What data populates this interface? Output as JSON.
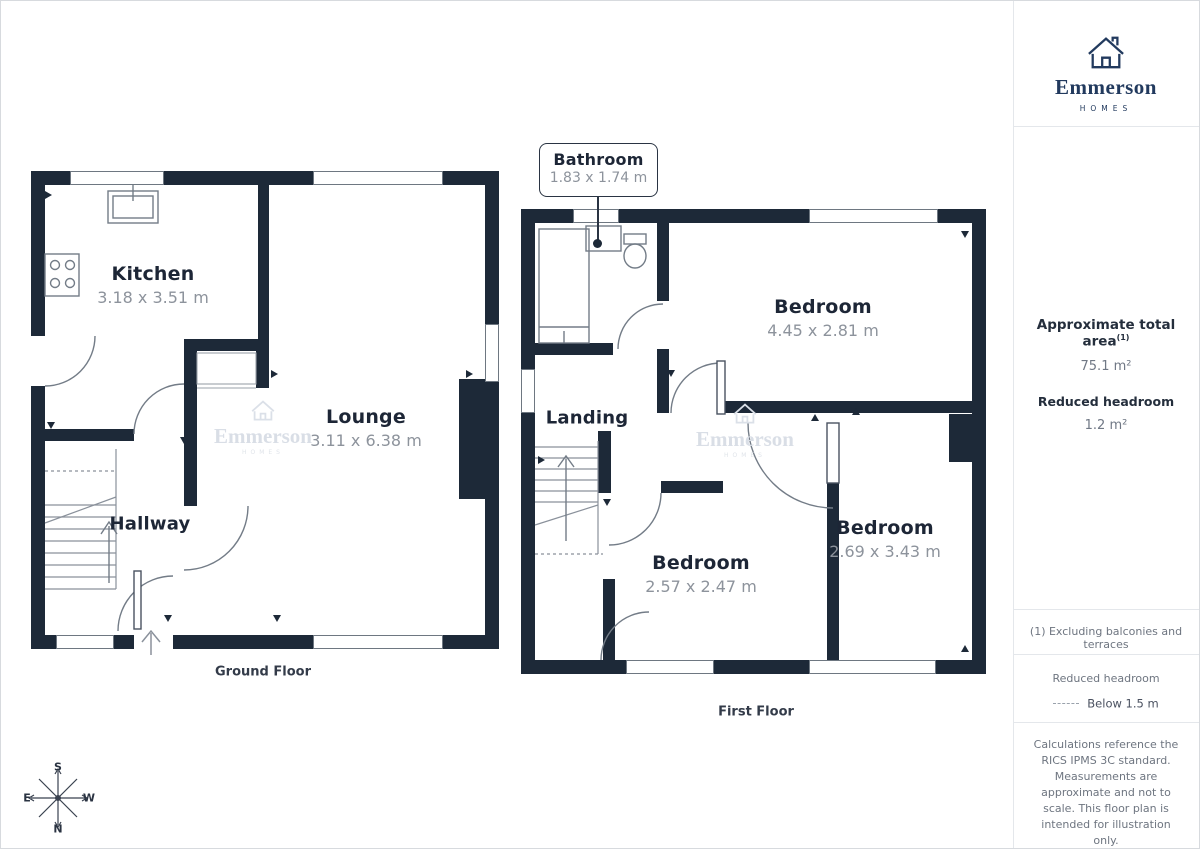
{
  "brand": {
    "name": "Emmerson",
    "tagline": "HOMES"
  },
  "sidebar": {
    "area_title": "Approximate total area",
    "area_title_sup": "(1)",
    "area_value": "75.1 m²",
    "headroom_title": "Reduced headroom",
    "headroom_value": "1.2 m²",
    "footnote": "(1) Excluding balconies and terraces",
    "legend_title": "Reduced headroom",
    "legend_label": "Below 1.5 m",
    "disclaimer": "Calculations reference the RICS IPMS 3C standard. Measurements are approximate and not to scale. This floor plan is intended for illustration only.",
    "credit_name": "GIRAFFE",
    "credit_suffix": "360"
  },
  "ground_floor": {
    "caption": "Ground Floor",
    "kitchen_name": "Kitchen",
    "kitchen_dims": "3.18 x 3.51 m",
    "lounge_name": "Lounge",
    "lounge_dims": "3.11 x 6.38 m",
    "hallway_name": "Hallway"
  },
  "first_floor": {
    "caption": "First Floor",
    "bathroom_name": "Bathroom",
    "bathroom_dims": "1.83 x 1.74 m",
    "bedroom_top_name": "Bedroom",
    "bedroom_top_dims": "4.45 x 2.81 m",
    "bedroom_right_name": "Bedroom",
    "bedroom_right_dims": "2.69 x 3.43 m",
    "bedroom_middle_name": "Bedroom",
    "bedroom_middle_dims": "2.57 x 2.47 m",
    "landing_name": "Landing"
  },
  "compass": {
    "north": "N",
    "south": "S",
    "east": "E",
    "west": "W"
  },
  "colors": {
    "wall": "#1d2938",
    "brand_navy": "#223a5e",
    "dim_text": "#8d939c",
    "line": "#6e7781",
    "callout_border": "#2a3443"
  }
}
